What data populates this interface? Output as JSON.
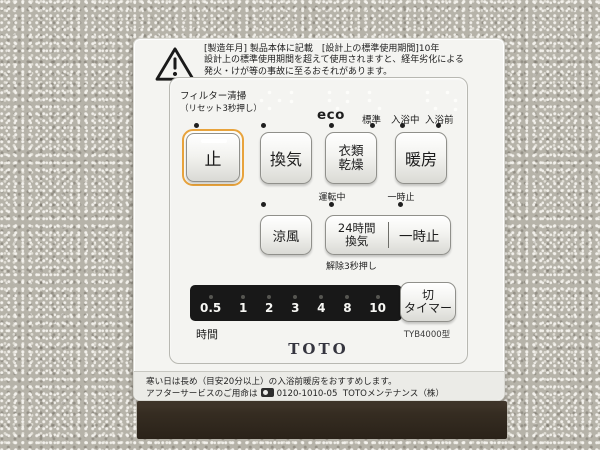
{
  "device": {
    "brand_logo": "TOTO",
    "model": "TYB4000型"
  },
  "warning": {
    "line1": "[製造年月] 製品本体に記載　[設計上の標準使用期間]10年",
    "line2": "設計上の標準使用期間を超えて使用されますと、経年劣化による",
    "line3": "発火・けが等の事故に至るおそれがあります。"
  },
  "labels": {
    "filter_clean": "フィルター清掃",
    "filter_reset": "（リセット3秒押し）",
    "eco": "eco",
    "standard": "標準",
    "in_bath": "入浴中",
    "pre_bath": "入浴前",
    "operating": "運転中",
    "pause_status": "一時止",
    "release_hold": "解除3秒押し",
    "hours_unit": "時間"
  },
  "buttons": {
    "stop": "止",
    "ventilation": "換気",
    "clothes_drying": [
      "衣類",
      "乾燥"
    ],
    "heating": "暖房",
    "cool_breeze": "涼風",
    "vent_24h": [
      "24時間",
      "換気"
    ],
    "pause": "一時止",
    "off_timer": [
      "切",
      "タイマー"
    ]
  },
  "timer": {
    "hours": [
      "0.5",
      "1",
      "2",
      "3",
      "4",
      "8",
      "10"
    ]
  },
  "footer": {
    "line1": "寒い日は長め（目安20分以上）の入浴前暖房をおすすめします。",
    "service_prefix": "アフターサービスのご用命は",
    "phone": "0120-1010-05",
    "service_suffix": "TOTOメンテナンス（株）"
  },
  "colors": {
    "accent_ring": "#e8a33c",
    "panel": "#f4f4f1",
    "display": "#181818",
    "wall": "#b6b3a9",
    "trim": "#362d22"
  }
}
